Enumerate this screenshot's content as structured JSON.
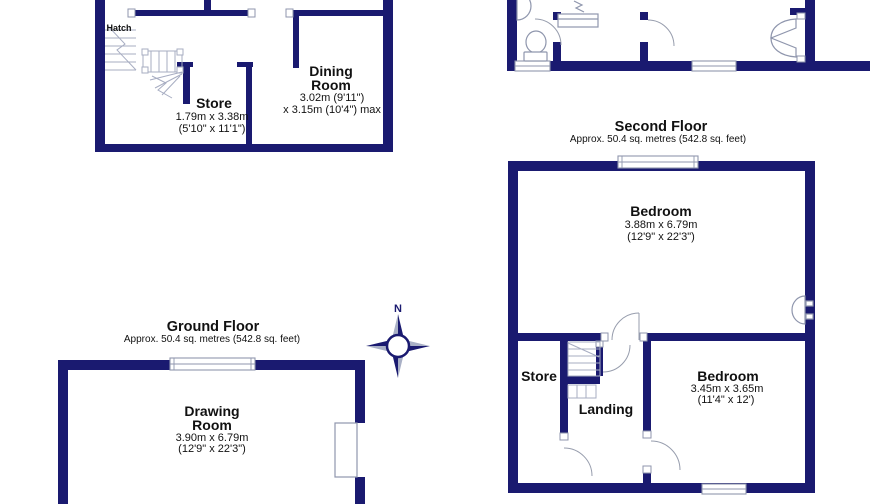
{
  "document": {
    "type": "floor-plan-sheet",
    "colors": {
      "wall": "#1a1a70",
      "fixture_line": "#8f96ad",
      "stair_line": "#a7adc2",
      "text": "#111111",
      "compass_light": "#a9b0c6",
      "background": "#ffffff"
    }
  },
  "labels": {
    "hatch": "Hatch",
    "store1": {
      "name": "Store",
      "dim_m": "1.79m x 3.38m",
      "dim_ft": "(5'10\" x 11'1\")"
    },
    "dining": {
      "name_line1": "Dining",
      "name_line2": "Room",
      "dim_m": "3.02m (9'11\")",
      "dim_ft": "x 3.15m (10'4\") max"
    },
    "second_floor": {
      "title": "Second Floor",
      "area": "Approx. 50.4 sq. metres (542.8 sq. feet)"
    },
    "bedroom1": {
      "name": "Bedroom",
      "dim_m": "3.88m x 6.79m",
      "dim_ft": "(12'9\" x 22'3\")"
    },
    "store2": "Store",
    "landing": "Landing",
    "bedroom2": {
      "name": "Bedroom",
      "dim_m": "3.45m x 3.65m",
      "dim_ft": "(11'4\" x 12')"
    },
    "ground_floor": {
      "title": "Ground Floor",
      "area": "Approx. 50.4 sq. metres (542.8 sq. feet)"
    },
    "drawing_room": {
      "name_line1": "Drawing",
      "name_line2": "Room",
      "dim_m": "3.90m x 6.79m",
      "dim_ft": "(12'9\" x 22'3\")"
    },
    "compass": {
      "north": "N"
    }
  }
}
